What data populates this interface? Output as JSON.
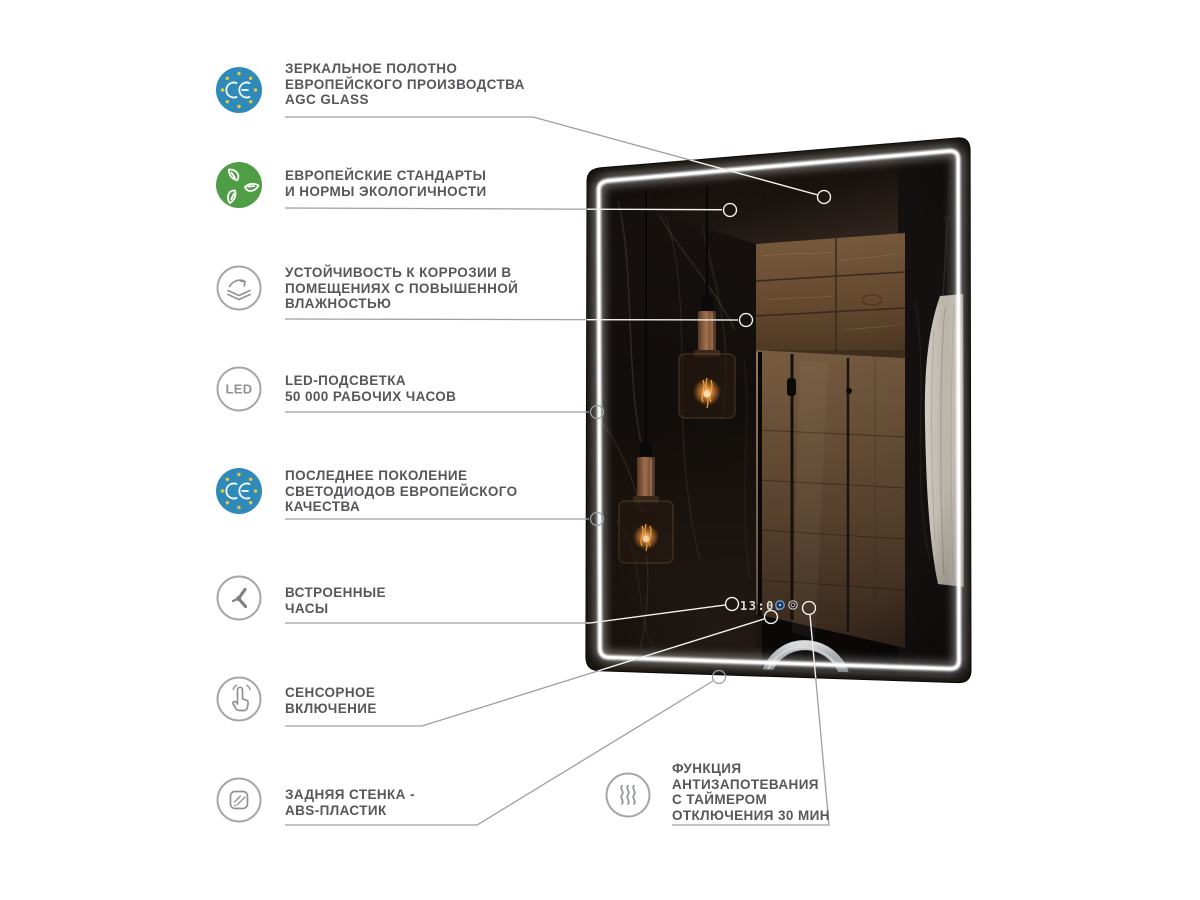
{
  "colors": {
    "ce_blue": "#2e8ab8",
    "eco_green": "#4f9d45",
    "star_yellow": "#f2c63a",
    "text_gray": "#56575b",
    "line_gray": "#9aa0a3",
    "led_white": "#ffffff"
  },
  "features": [
    {
      "id": "agc-glass",
      "icon": "ce-mark",
      "lines": [
        "ЗЕРКАЛЬНОЕ  ПОЛОТНО",
        "ЕВРОПЕЙСКОГО ПРОИЗВОДСТВА",
        "AGC GLASS"
      ]
    },
    {
      "id": "eco",
      "icon": "eco-leaves",
      "lines": [
        "ЕВРОПЕЙСКИЕ СТАНДАРТЫ",
        "И НОРМЫ ЭКОЛОГИЧНОСТИ"
      ]
    },
    {
      "id": "corrosion",
      "icon": "corrosion-layers",
      "lines": [
        "УСТОЙЧИВОСТЬ К КОРРОЗИИ В",
        "ПОМЕЩЕНИЯХ С ПОВЫШЕННОЙ",
        "ВЛАЖНОСТЬЮ"
      ]
    },
    {
      "id": "led-life",
      "icon": "led-badge",
      "lines": [
        "LED-ПОДСВЕТКА",
        "50 000 РАБОЧИХ ЧАСОВ"
      ]
    },
    {
      "id": "diodes",
      "icon": "ce-mark",
      "lines": [
        "ПОСЛЕДНЕЕ ПОКОЛЕНИЕ",
        "СВЕТОДИОДОВ ЕВРОПЕЙСКОГО",
        "КАЧЕСТВА"
      ]
    },
    {
      "id": "clock",
      "icon": "clock",
      "lines": [
        "ВСТРОЕННЫЕ",
        "ЧАСЫ"
      ]
    },
    {
      "id": "touch",
      "icon": "touch",
      "lines": [
        "СЕНСОРНОЕ",
        "ВКЛЮЧЕНИЕ"
      ]
    },
    {
      "id": "abs-back",
      "icon": "abs-panel",
      "lines": [
        "ЗАДНЯЯ СТЕНКА -",
        "ABS-ПЛАСТИК"
      ]
    },
    {
      "id": "antifog",
      "icon": "steam",
      "lines": [
        "ФУНКЦИЯ",
        "АНТИЗАПОТЕВАНИЯ",
        "С ТАЙМЕРОМ",
        "ОТКЛЮЧЕНИЯ 30 МИН"
      ]
    }
  ],
  "icons": {
    "led_label": "LED"
  },
  "mirror": {
    "clock_time": "13:06"
  }
}
